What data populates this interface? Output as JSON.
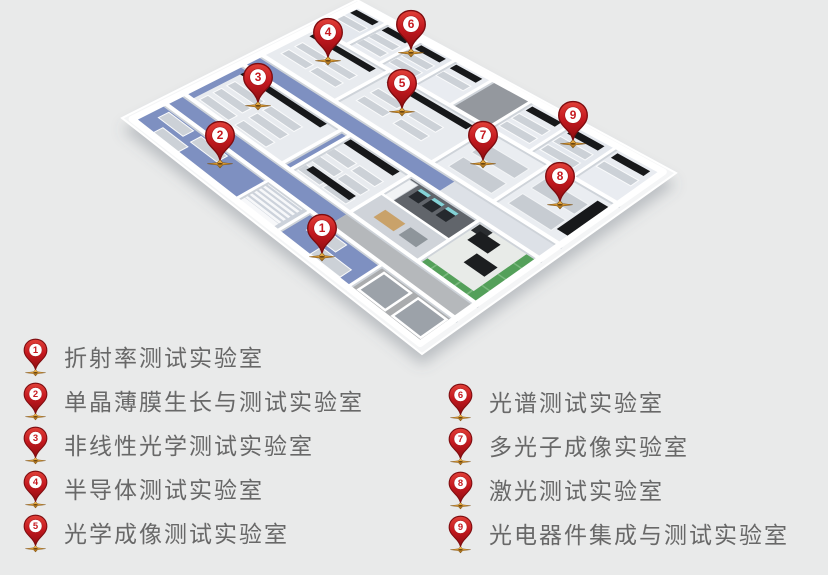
{
  "legend": {
    "columns": [
      {
        "name": "left",
        "items": [
          {
            "num": "1",
            "label": "折射率测试实验室"
          },
          {
            "num": "2",
            "label": "单晶薄膜生长与测试实验室"
          },
          {
            "num": "3",
            "label": "非线性光学测试实验室"
          },
          {
            "num": "4",
            "label": "半导体测试实验室"
          },
          {
            "num": "5",
            "label": "光学成像测试实验室"
          }
        ]
      },
      {
        "name": "right",
        "items": [
          {
            "num": "6",
            "label": "光谱测试实验室"
          },
          {
            "num": "7",
            "label": "多光子成像实验室"
          },
          {
            "num": "8",
            "label": "激光测试实验室"
          },
          {
            "num": "9",
            "label": "光电器件集成与测试实验室"
          }
        ]
      }
    ]
  },
  "map_pins": [
    {
      "num": "1",
      "x": 322,
      "y": 256
    },
    {
      "num": "2",
      "x": 220,
      "y": 163
    },
    {
      "num": "3",
      "x": 258,
      "y": 105
    },
    {
      "num": "4",
      "x": 328,
      "y": 60
    },
    {
      "num": "5",
      "x": 402,
      "y": 111
    },
    {
      "num": "6",
      "x": 411,
      "y": 52
    },
    {
      "num": "7",
      "x": 483,
      "y": 163
    },
    {
      "num": "8",
      "x": 560,
      "y": 204
    },
    {
      "num": "9",
      "x": 573,
      "y": 143
    }
  ],
  "colors": {
    "background": "#e9eaea",
    "pin_red_light": "#e04038",
    "pin_red": "#c61a20",
    "pin_red_dark": "#8e0c10",
    "pin_outline": "#7d0c0f",
    "star_gold_light": "#f3bd55",
    "star_gold": "#d99a33",
    "star_gold_dark": "#8d5c15",
    "corridor_blue": "#7e90c1",
    "cabinet_green": "#54a05a",
    "counter_black": "#17181a",
    "label_text": "#686868"
  }
}
